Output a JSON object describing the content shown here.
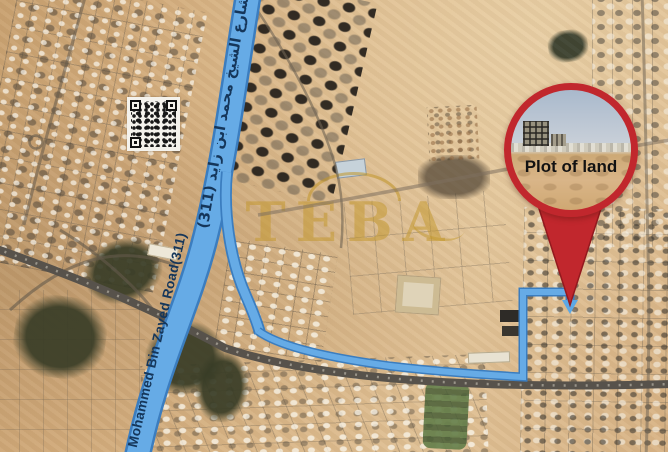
{
  "map": {
    "description": "Satellite location map of a plot of land near Mohammed Bin Zayed Road",
    "pin": {
      "label": "Plot of land"
    },
    "road": {
      "label_arabic": "شارع الشيخ محمد ابن زايد (311)",
      "label_english": "Mohammed Bin Zayed Road(311)"
    },
    "watermark": {
      "brand": "TEBA"
    },
    "colors": {
      "route_blue": "#66abe6",
      "route_edge_blue": "#3b7dbf",
      "pin_red": "#c1272d",
      "label_navy": "#15365a",
      "watermark_gold": "#c19628",
      "sand": "#d9b586",
      "highway_gray": "#57524b",
      "vegetation_dark": "#383c26"
    },
    "icons": [
      "location-pin",
      "qr-code",
      "route-arrow-icon"
    ]
  }
}
